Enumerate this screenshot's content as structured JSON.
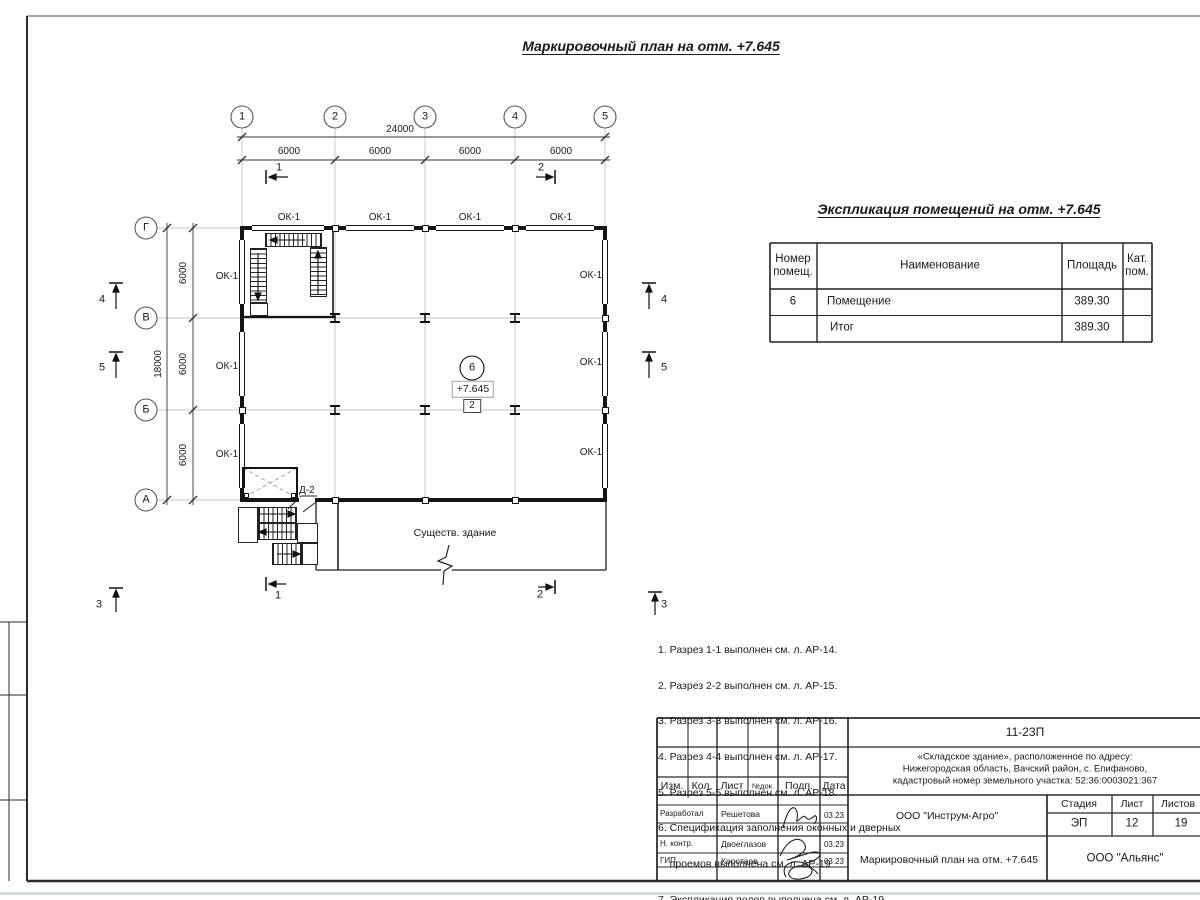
{
  "page": {
    "title": "Маркировочный план на отм. +7.645"
  },
  "plan": {
    "axes_cols": [
      "1",
      "2",
      "3",
      "4",
      "5"
    ],
    "axes_rows": [
      "Г",
      "В",
      "Б",
      "А"
    ],
    "dims": {
      "total_w": "24000",
      "total_h": "18000",
      "bay": "6000"
    },
    "window_label": "ОК-1",
    "door_label": "Д-2",
    "existing_building": "Существ. здание",
    "room_number": "6",
    "room_elevation": "+7.645",
    "room_zone": "2",
    "sections": {
      "s1": "1",
      "s2": "2",
      "s3": "3",
      "s4": "4",
      "s5": "5"
    }
  },
  "rooms_table": {
    "title": "Экспликация помещений на отм. +7.645",
    "headers": {
      "num": "Номер помещ.",
      "name": "Наименование",
      "area": "Площадь",
      "cat": "Кат. пом."
    },
    "rows": [
      {
        "num": "6",
        "name": "Помещение",
        "area": "389.30",
        "cat": ""
      },
      {
        "num": "",
        "name": "Итог",
        "area": "389.30",
        "cat": ""
      }
    ]
  },
  "notes": {
    "lines": [
      "1. Разрез 1-1 выполнен см. л. АР-14.",
      "2. Разрез 2-2 выполнен см. л. АР-15.",
      "3. Разрез 3-3 выполнен см. л. АР-16.",
      "4. Разрез 4-4 выполнен см. л. АР-17.",
      "5. Разрез 5-5 выполнен см. л. АР-18.",
      "6. Спецификация заполнения оконных и дверных",
      "    проемов выполнена см. л. АР-19",
      "7. Экспликация полов выполнена см. л. АР-19."
    ]
  },
  "title_block": {
    "project_code": "11-23П",
    "object_line1": "«Складское здание», расположенное по адресу:",
    "object_line2": "Нижегородская область, Вачский район, с. Епифаново,",
    "object_line3": "кадастровый номер земельного участка: 52:36:0003021:367",
    "col_izm": "Изм.",
    "col_kol": "Кол.",
    "col_list": "Лист",
    "col_ndok": "№док.",
    "col_podp": "Подп.",
    "col_data": "Дата",
    "row1_role": "Разработал",
    "row1_name": "Решетова",
    "row1_date": "03.23",
    "row2_role": "Н. контр.",
    "row2_name": "Двоеглазов",
    "row2_date": "03.23",
    "row3_role": "ГИП",
    "row3_name": "Коротаев",
    "row3_date": "03.23",
    "org": "ООО \"Инструм-Агро\"",
    "stage_label": "Стадия",
    "sheet_label": "Лист",
    "sheets_label": "Листов",
    "stage": "ЭП",
    "sheet": "12",
    "sheets": "19",
    "doc_title": "Маркировочный план на отм. +7.645",
    "org2": "ООО \"Альянс\""
  }
}
